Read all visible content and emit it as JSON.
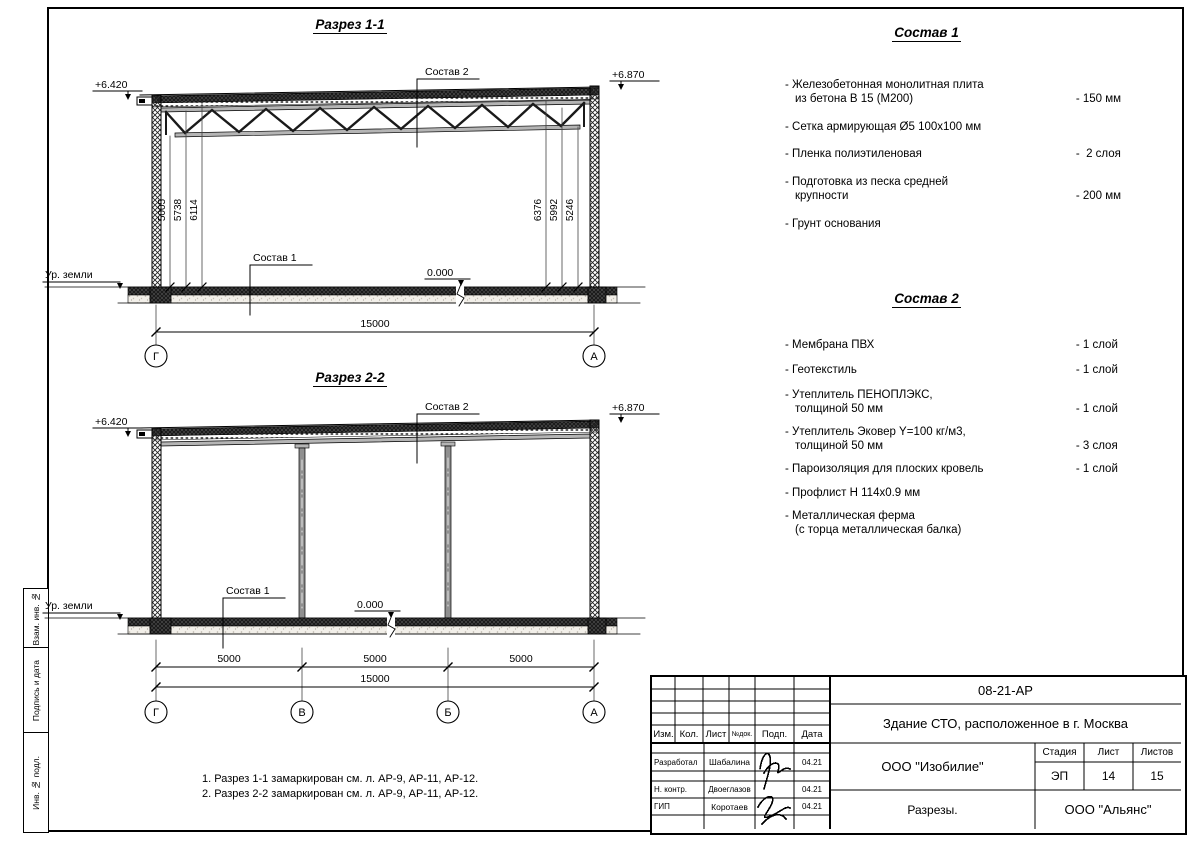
{
  "sheet": {
    "side_labels": [
      "Взам. инв. №",
      "Подпись и дата",
      "Инв. № подл."
    ],
    "notes": [
      "1. Разрез 1-1 замаркирован см. л. АР-9, АР-11, АР-12.",
      "2. Разрез 2-2 замаркирован см. л. АР-9, АР-11, АР-12."
    ]
  },
  "section1": {
    "title": "Разрез 1-1",
    "elev_left": "+6.420",
    "elev_right": "+6.870",
    "callout_roof": "Состав 2",
    "callout_floor": "Состав 1",
    "ground_label": "Ур. земли",
    "zero_level": "0.000",
    "dims_left": [
      "5005",
      "5738",
      "6114"
    ],
    "dims_right": [
      "6376",
      "5992",
      "5246"
    ],
    "dim_total": "15000",
    "axis_left": "Г",
    "axis_right": "А"
  },
  "section2": {
    "title": "Разрез 2-2",
    "elev_left": "+6.420",
    "elev_right": "+6.870",
    "callout_roof": "Состав 2",
    "callout_floor": "Состав 1",
    "ground_label": "Ур. земли",
    "zero_level": "0.000",
    "dims_bays": [
      "5000",
      "5000",
      "5000"
    ],
    "dim_total": "15000",
    "axes": [
      "Г",
      "В",
      "Б",
      "А"
    ]
  },
  "composition1": {
    "title": "Состав 1",
    "items": [
      {
        "name": "- Железобетонная  монолитная плита\nиз бетона В 15 (М200)",
        "value": "- 150 мм"
      },
      {
        "name": "- Сетка армирующая Ø5 100x100 мм",
        "value": ""
      },
      {
        "name": "- Пленка полиэтиленовая",
        "value": "-  2 слоя"
      },
      {
        "name": "- Подготовка из песка средней\nкрупности",
        "value": "- 200 мм"
      },
      {
        "name": "- Грунт основания",
        "value": ""
      }
    ]
  },
  "composition2": {
    "title": "Состав 2",
    "items": [
      {
        "name": "- Мембрана ПВХ",
        "value": "- 1 слой"
      },
      {
        "name": "- Геотекстиль",
        "value": "- 1 слой"
      },
      {
        "name": "- Утеплитель ПЕНОПЛЭКС,\nтолщиной 50 мм",
        "value": "- 1 слой"
      },
      {
        "name": "- Утеплитель Эковер Y=100 кг/м3,\nтолщиной 50 мм",
        "value": "- 3 слоя"
      },
      {
        "name": "- Пароизоляция для плоских кровель",
        "value": "- 1 слой"
      },
      {
        "name": "- Профлист Н 114x0.9 мм",
        "value": ""
      },
      {
        "name": "- Металлическая ферма\n(с торца металлическая балка)",
        "value": ""
      }
    ]
  },
  "titleblock": {
    "doc_number": "08-21-АР",
    "project_title": "Здание СТО, расположенное в г. Москва",
    "designer_org": "ООО \"Изобилие\"",
    "drawing_title": "Разрезы.",
    "client_org": "ООО \"Альянс\"",
    "stage_label": "Стадия",
    "stage_value": "ЭП",
    "sheet_label": "Лист",
    "sheet_value": "14",
    "sheets_label": "Листов",
    "sheets_value": "15",
    "columns": [
      "Изм.",
      "Кол.",
      "Лист",
      "№док.",
      "Подп.",
      "Дата"
    ],
    "rows": [
      {
        "role": "Разработал",
        "name": "Шабалина",
        "date": "04.21"
      },
      {
        "role": "Н. контр.",
        "name": "Двоеглазов",
        "date": "04.21"
      },
      {
        "role": "ГИП",
        "name": "Коротаев",
        "date": "04.21"
      }
    ]
  }
}
